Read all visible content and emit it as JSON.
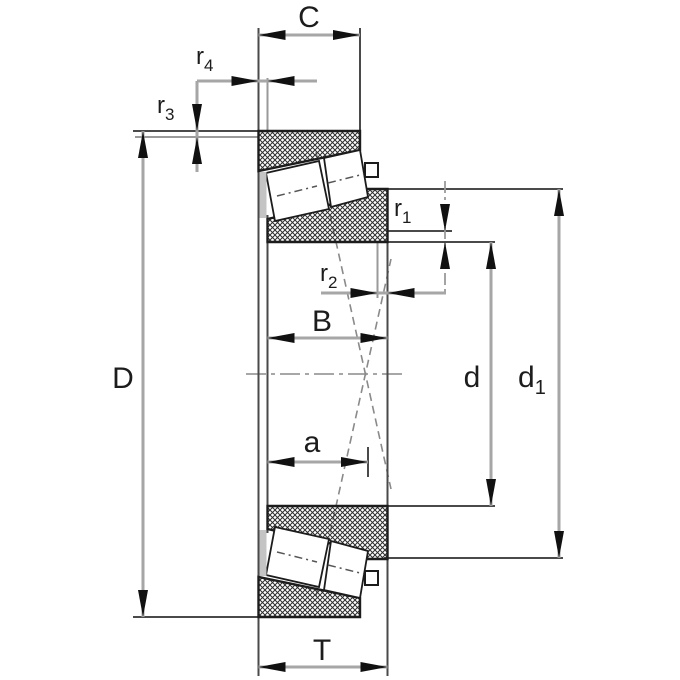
{
  "figure": {
    "kind": "tapered-roller-bearing-dimension-drawing",
    "dimension_labels": {
      "C": "C",
      "D": "D",
      "B": "B",
      "a": "a",
      "T": "T",
      "d": "d",
      "d1": {
        "base": "d",
        "sub": "1"
      },
      "r1": {
        "base": "r",
        "sub": "1"
      },
      "r2": {
        "base": "r",
        "sub": "2"
      },
      "r3": {
        "base": "r",
        "sub": "3"
      },
      "r4": {
        "base": "r",
        "sub": "4"
      }
    },
    "colors": {
      "background": "#ffffff",
      "part_outline": "#1c1c1c",
      "hatch": "#2e2e2e",
      "dimension_line": "#a6a6a6",
      "extension_line": "#4a4a4a",
      "arrow": "#111111",
      "label_text": "#1c1c1c",
      "cage": "#c4c4c4"
    }
  }
}
